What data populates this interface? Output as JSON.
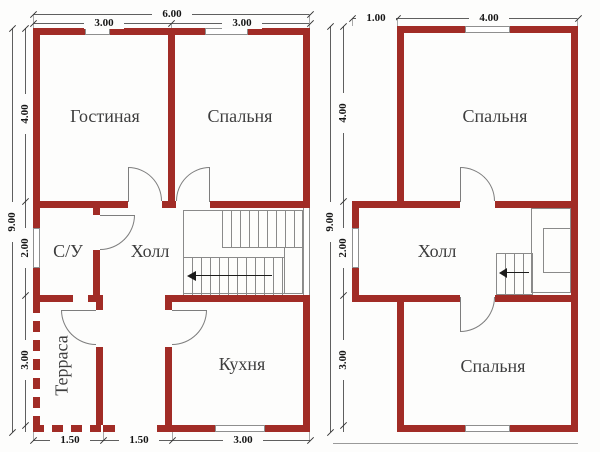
{
  "left": {
    "rooms": {
      "living": "Гостиная",
      "bedroom": "Спальня",
      "bathroom": "С/У",
      "hall": "Холл",
      "terrace": "Терраса",
      "kitchen": "Кухня"
    },
    "dims": {
      "total_width": "6.00",
      "top_left": "3.00",
      "top_right": "3.00",
      "height": "9.00",
      "side_top": "4.00",
      "side_mid": "2.00",
      "side_bottom": "3.00",
      "bottom_left": "1.50",
      "bottom_mid": "1.50",
      "bottom_right": "3.00"
    }
  },
  "right": {
    "rooms": {
      "bedroom_top": "Спальня",
      "hall": "Холл",
      "bedroom_bottom": "Спальня"
    },
    "dims": {
      "top_left": "1.00",
      "top_right": "4.00",
      "height": "9.00",
      "side_top": "4.00",
      "side_mid": "2.00",
      "side_bottom": "3.00"
    }
  },
  "colors": {
    "wall": "#a12c26",
    "dimension_line": "#5f5f5f",
    "text": "#3d3d3d"
  }
}
